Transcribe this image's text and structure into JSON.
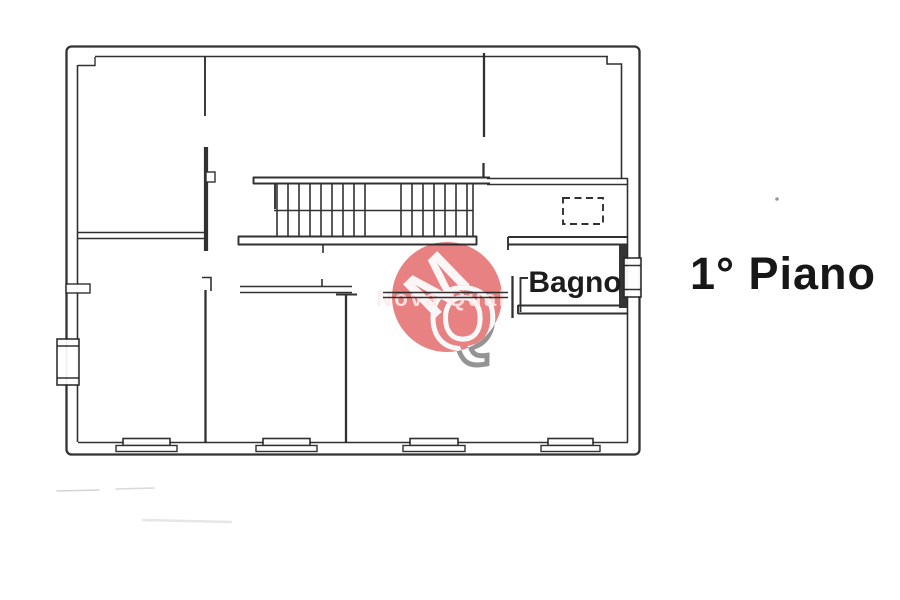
{
  "page": {
    "background_color": "#ffffff",
    "ink_color": "#262626"
  },
  "plan": {
    "floor_label": "1° Piano",
    "rooms": [
      {
        "label": "Bagno"
      }
    ],
    "watermark": {
      "text": "Nova Qual",
      "monogram_letters": [
        "M",
        "Q"
      ],
      "circle_color": "#e15f5f"
    }
  }
}
